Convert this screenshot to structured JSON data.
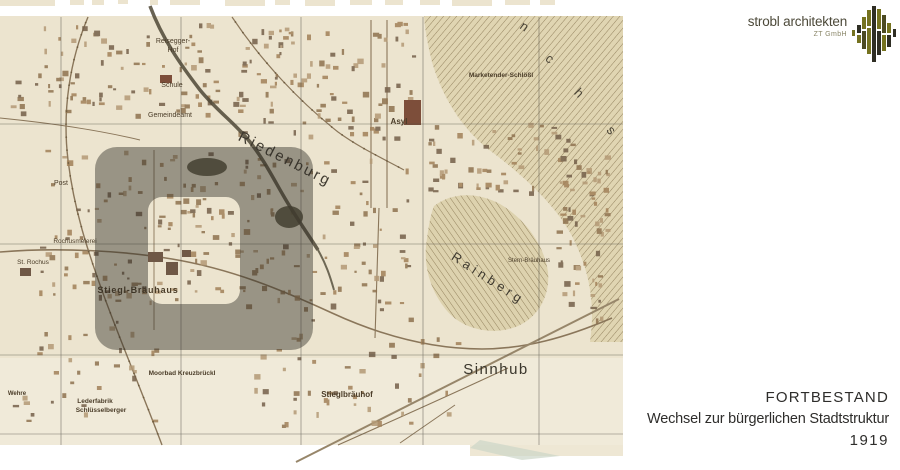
{
  "slide": {
    "logo": {
      "name": "strobl architekten",
      "suffix": "ZT GmbH",
      "colors": {
        "text": "#4d4a3a",
        "suffix": "#8a8668",
        "bar_olive": "#75721f",
        "bar_dark": "#2f2e24"
      }
    },
    "caption": {
      "title": "FORTBESTAND",
      "subtitle": "Wechsel zur bürgerlichen Stadtstruktur",
      "year": "1919",
      "color": "#2e2d2b"
    }
  },
  "map": {
    "description": "Historical sepia city map of the Riedenburg district (Salzburg), 1919, with a dark highlight frame around the Stiegl-Bräuhaus quarter",
    "paper_color": "#ece4cf",
    "field_color": "#f0ead9",
    "ink_color": "#8a765a",
    "building_color": "#9a7c5c",
    "hill_color": "#e0d5b2",
    "grid_color": "#4f4c44",
    "label_color": "#4a3c28",
    "highlight_overlay": "rgba(48,46,38,0.44)",
    "grid": {
      "vertical_x": [
        61,
        181,
        301,
        423,
        539
      ],
      "horizontal_y": [
        124,
        244,
        355,
        434
      ]
    },
    "labels": [
      {
        "id": "riedenburg",
        "text": "Riedenburg",
        "x": 283,
        "y": 163,
        "size": 15,
        "rot": 27,
        "ls": 2.5,
        "color": "#3f3a30"
      },
      {
        "id": "rainberg",
        "text": "Rainberg",
        "x": 486,
        "y": 282,
        "size": 13,
        "rot": 33,
        "ls": 4,
        "color": "#3f3a30"
      },
      {
        "id": "sinnhub",
        "text": "Sinnhub",
        "x": 496,
        "y": 374,
        "size": 15,
        "ls": 1.5,
        "color": "#3a362c"
      },
      {
        "id": "moenchsberg-n",
        "text": "n",
        "x": 522,
        "y": 30,
        "size": 13,
        "rot": 35,
        "serif": true,
        "color": "#4a4436"
      },
      {
        "id": "moenchsberg-c",
        "text": "c",
        "x": 547,
        "y": 62,
        "size": 13,
        "rot": 40,
        "serif": true,
        "color": "#4a4436"
      },
      {
        "id": "moenchsberg-h",
        "text": "h",
        "x": 576,
        "y": 96,
        "size": 13,
        "rot": 45,
        "serif": true,
        "color": "#4a4436"
      },
      {
        "id": "moenchsberg-s",
        "text": "s",
        "x": 608,
        "y": 133,
        "size": 13,
        "rot": 50,
        "serif": true,
        "color": "#4a4436"
      },
      {
        "id": "asyl",
        "text": "Asyl",
        "x": 399,
        "y": 124,
        "size": 8,
        "bold": true
      },
      {
        "id": "stiegl-braeuhaus",
        "text": "Stiegl-Bräuhaus",
        "x": 138,
        "y": 293,
        "size": 9,
        "bold": true,
        "ls": 0.8
      },
      {
        "id": "stieglbraeuhof",
        "text": "Stieglbräuhof",
        "x": 347,
        "y": 397,
        "size": 8,
        "bold": true
      },
      {
        "id": "moorbad-kreuzbrueckl",
        "text": "Moorbad Kreuzbrückl",
        "x": 182,
        "y": 375,
        "size": 6.5,
        "bold": true
      },
      {
        "id": "lederfabrik",
        "text": "Lederfabrik",
        "x": 95,
        "y": 403,
        "size": 6.5,
        "bold": true
      },
      {
        "id": "schluesselberger",
        "text": "Schlüsselberger",
        "x": 101,
        "y": 412,
        "size": 6.5,
        "bold": true
      },
      {
        "id": "wehre",
        "text": "Wehre",
        "x": 17,
        "y": 395,
        "size": 6,
        "bold": true
      },
      {
        "id": "marketender-schloessl",
        "text": "Marketender-Schlößl",
        "x": 501,
        "y": 77,
        "size": 6.5,
        "bold": true
      },
      {
        "id": "reisegger-hof-line1",
        "text": "Reisegger-",
        "x": 173,
        "y": 43,
        "size": 7
      },
      {
        "id": "reisegger-hof-line2",
        "text": "Hof",
        "x": 173,
        "y": 52,
        "size": 7
      },
      {
        "id": "schule",
        "text": "Schule",
        "x": 172,
        "y": 87,
        "size": 7
      },
      {
        "id": "gemeindeamt",
        "text": "Gemeindeamt",
        "x": 170,
        "y": 117,
        "size": 7
      },
      {
        "id": "stern-braeuhaus",
        "text": "Stern-Bräuhaus",
        "x": 529,
        "y": 262,
        "size": 6
      },
      {
        "id": "post",
        "text": "Post",
        "x": 61,
        "y": 185,
        "size": 7
      },
      {
        "id": "rochusmeierei",
        "text": "Rochusmeierei",
        "x": 75,
        "y": 243,
        "size": 6.5
      },
      {
        "id": "st-rochus",
        "text": "St. Rochus",
        "x": 33,
        "y": 264,
        "size": 6.5
      }
    ]
  }
}
